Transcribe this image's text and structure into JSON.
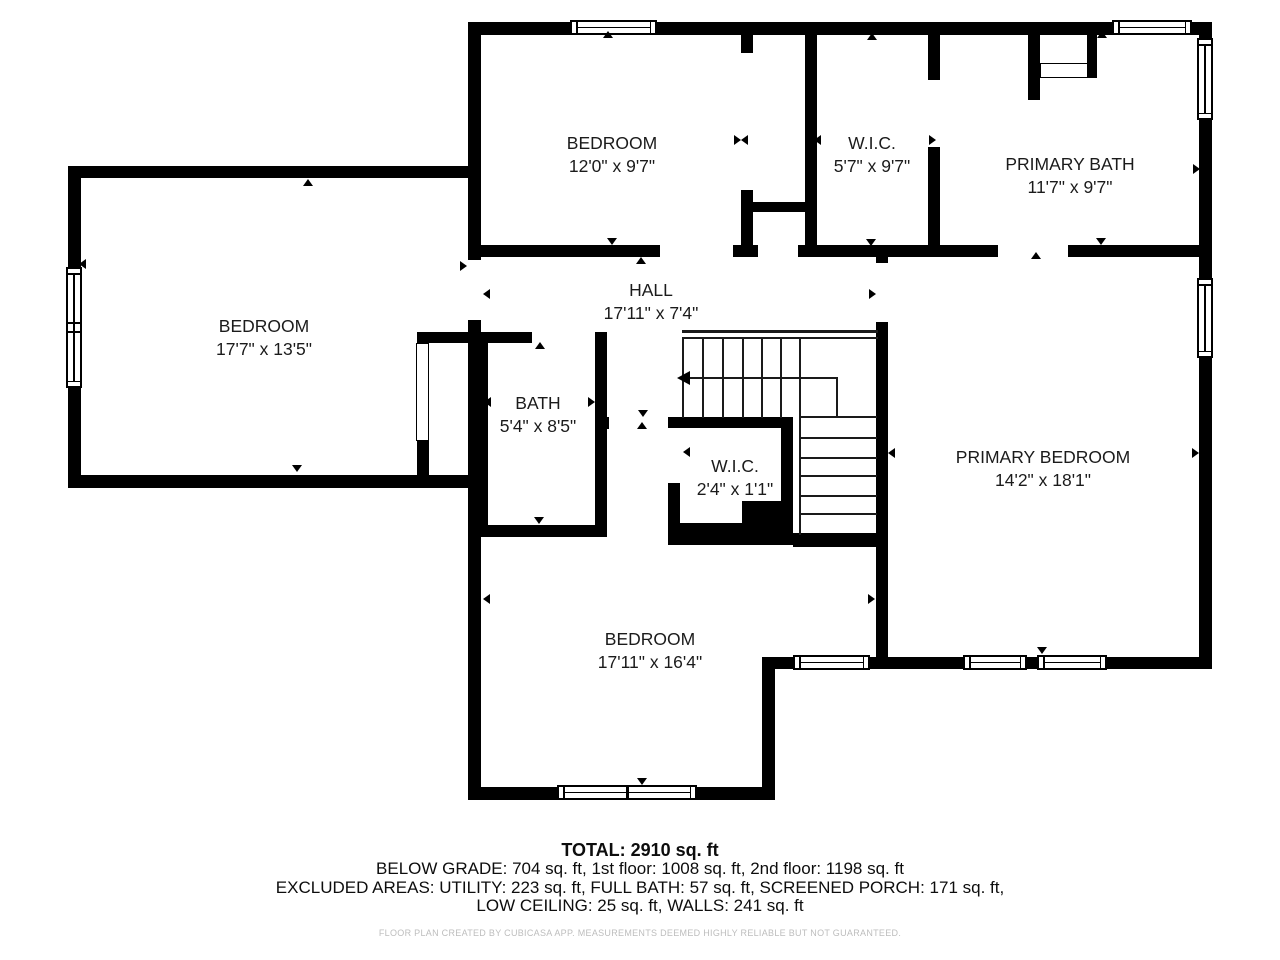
{
  "rooms": [
    {
      "name": "BEDROOM",
      "dims": "12'0\" x 9'7\""
    },
    {
      "name": "W.I.C.",
      "dims": "5'7\" x 9'7\""
    },
    {
      "name": "PRIMARY BATH",
      "dims": "11'7\" x 9'7\""
    },
    {
      "name": "BEDROOM",
      "dims": "17'7\" x 13'5\""
    },
    {
      "name": "HALL",
      "dims": "17'11\" x 7'4\""
    },
    {
      "name": "BATH",
      "dims": "5'4\" x 8'5\""
    },
    {
      "name": "W.I.C.",
      "dims": "2'4\" x 1'1\""
    },
    {
      "name": "PRIMARY BEDROOM",
      "dims": "14'2\" x 18'1\""
    },
    {
      "name": "BEDROOM",
      "dims": "17'11\" x 16'4\""
    }
  ],
  "summary": {
    "total": "TOTAL: 2910 sq. ft",
    "line1": "BELOW GRADE: 704 sq. ft, 1st floor: 1008 sq. ft, 2nd floor: 1198 sq. ft",
    "line2": "EXCLUDED AREAS: UTILITY: 223 sq. ft, FULL BATH: 57 sq. ft, SCREENED PORCH: 171 sq. ft,",
    "line3": "LOW CEILING: 25 sq. ft, WALLS: 241 sq. ft"
  },
  "disclaimer": "FLOOR PLAN CREATED BY CUBICASA APP. MEASUREMENTS DEEMED HIGHLY RELIABLE BUT NOT GUARANTEED.",
  "colors": {
    "wall": "#000000",
    "background": "#ffffff",
    "disclaimer_text": "#bdbdbd"
  }
}
